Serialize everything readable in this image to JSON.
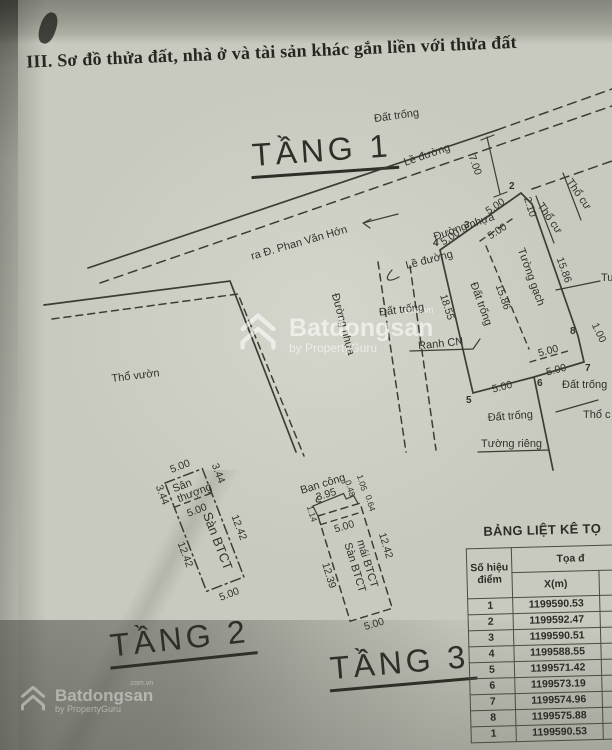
{
  "document": {
    "title": "III. Sơ đồ thửa đất, nhà ở và tài sản khác gắn liền với thửa đất"
  },
  "floor1": {
    "label": "TẦNG 1",
    "areas": {
      "dat_trong_top": "Đất trống",
      "tho_vuon": "Thổ vườn",
      "dat_trong_left": "Đất trống",
      "dat_trong_inside": "Đất trống",
      "tho_cu_a": "Thổ cư",
      "tho_cu_b": "Thổ cư",
      "dat_trong_right": "Đất trống",
      "dat_trong_below": "Đất trống",
      "tho_cu_cut": "Thổ c",
      "tuong_cut": "Tu"
    },
    "roads": {
      "le_duong_main": "Lề đường",
      "duong_nhua_main": "Đường nhựa",
      "exit": "ra Đ. Phan Văn Hớn",
      "le_duong_branch": "Lề đường",
      "duong_nhua_branch": "Đường nhựa"
    },
    "walls": {
      "tuong_gach": "Tường gạch",
      "tuong_rieng": "Tường riêng",
      "ranh_cn": "Ranh CN"
    },
    "dims": {
      "road_width": "7.00",
      "top_a": "5.00",
      "top_b": "5.00",
      "top_inner": "5.00",
      "d210": "2.10",
      "left": "18.55",
      "inner": "15.86",
      "right": "15.86",
      "bottom_inner": "5.00",
      "bottom_a": "5.00",
      "bottom_b": "5.00",
      "d100": "1.00"
    },
    "points": {
      "p2": "2",
      "p3": "3",
      "p4": "4",
      "p5": "5",
      "p6": "6",
      "p7": "7",
      "p8": "8"
    }
  },
  "floor2": {
    "label": "TẦNG 2",
    "san_thuong_1": "Sân",
    "san_thuong_2": "thượng",
    "san_btct": "Sàn BTCT",
    "dims": {
      "top": "5.00",
      "top_right": "3.44",
      "top_left": "3.44",
      "inner": "5.00",
      "right": "12.42",
      "left": "12.42",
      "bottom": "5.00"
    }
  },
  "floor3": {
    "label": "TẦNG 3",
    "ban_cong": "Ban công",
    "san_btct": "Sàn BTCT",
    "mai_btct": "mái BTCT",
    "dims": {
      "balcony_w": "3.95",
      "d048": "0.48",
      "d105": "1.05",
      "d114": "1.14",
      "d064": "0.64",
      "inner": "5.00",
      "right": "12.42",
      "left": "12.39",
      "bottom": "5.00"
    }
  },
  "table": {
    "title": "BẢNG LIỆT KÊ TỌ",
    "header": {
      "col_point_1": "Số hiệu",
      "col_point_2": "điểm",
      "col_coord": "Tọa đ",
      "col_x": "X(m)"
    },
    "rows": [
      {
        "stt": "1",
        "x": "1199590.53"
      },
      {
        "stt": "2",
        "x": "1199592.47"
      },
      {
        "stt": "3",
        "x": "1199590.51"
      },
      {
        "stt": "4",
        "x": "1199588.55"
      },
      {
        "stt": "5",
        "x": "1199571.42"
      },
      {
        "stt": "6",
        "x": "1199573.19"
      },
      {
        "stt": "7",
        "x": "1199574.96"
      },
      {
        "stt": "8",
        "x": "1199575.88"
      },
      {
        "stt": "1",
        "x": "1199590.53"
      }
    ]
  },
  "watermark": {
    "brand": "Batdongsan",
    "tld": ".com.vn",
    "by": "by PropertyGuru"
  },
  "colors": {
    "ink": "#3c3d33",
    "paper": "#c9cabf"
  }
}
